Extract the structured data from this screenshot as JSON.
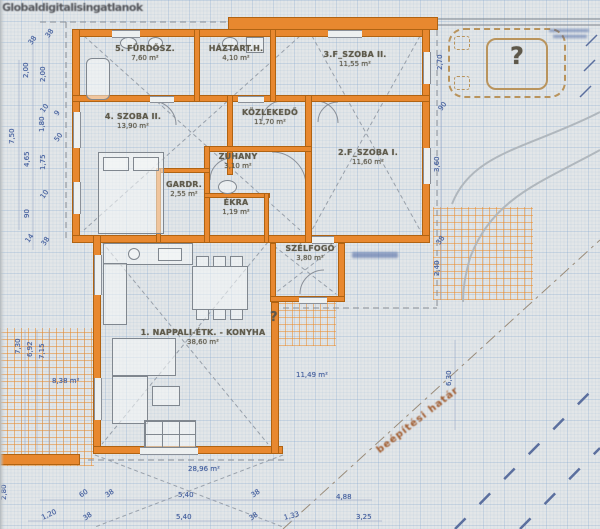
{
  "watermark": "Globaldigitalisingatlanok",
  "rooms": {
    "furdo": {
      "name": "5. FÜRDŐSZ.",
      "area": "7,60 m²"
    },
    "haztart": {
      "name": "HÁZTART.H.",
      "area": "4,10 m²"
    },
    "szoba3f": {
      "name": "3.F_SZOBA II.",
      "area": "11,55 m²"
    },
    "szoba4": {
      "name": "4. SZOBA II.",
      "area": "13,90 m²"
    },
    "kozlekedo": {
      "name": "KÖZLEKEDŐ",
      "area": "11,70 m²"
    },
    "szoba2f": {
      "name": "2.F_SZOBA I.",
      "area": "11,60 m²"
    },
    "zuhany": {
      "name": "ZUHANY",
      "area": "3,10 m²"
    },
    "gardrob": {
      "name": "GARDR.",
      "area": "2,55 m²"
    },
    "ekra": {
      "name": "ÉKRA",
      "area": "1,19 m²"
    },
    "szelfogo": {
      "name": "SZÉLFOGÓ",
      "area": "3,80 m²"
    },
    "nappali": {
      "name": "1. NAPPALI-ÉTK. - KONYHA",
      "area": "38,60 m²"
    }
  },
  "annotations": {
    "terrace_area": "28,96 m²",
    "left_area": "8,38 m²",
    "right_area": "11,49 m²",
    "building_limit": "beépítési határ",
    "question_mark": "?"
  },
  "dimensions": {
    "left": [
      "38",
      "38",
      "2,00",
      "2,00",
      "10",
      "9",
      "7,50",
      "1,80",
      "50",
      "4,65",
      "1,75",
      "10",
      "90",
      "14",
      "38"
    ],
    "left_lower": [
      "7,30",
      "6,92",
      "7,15"
    ],
    "bottom_row1": [
      "60",
      "38",
      "5,40",
      "38",
      "4,88"
    ],
    "bottom_row2": [
      "2,80",
      "1,20",
      "38",
      "5,40",
      "38",
      "1,33",
      "3,25"
    ],
    "right": [
      "2,70",
      "90",
      "3,60",
      "38",
      "2,40",
      "6,30"
    ]
  },
  "colors": {
    "wall": "#e8882f",
    "dim_text": "#46619f",
    "label_text": "#5f5b4c",
    "limit_text": "#a05a2c"
  }
}
